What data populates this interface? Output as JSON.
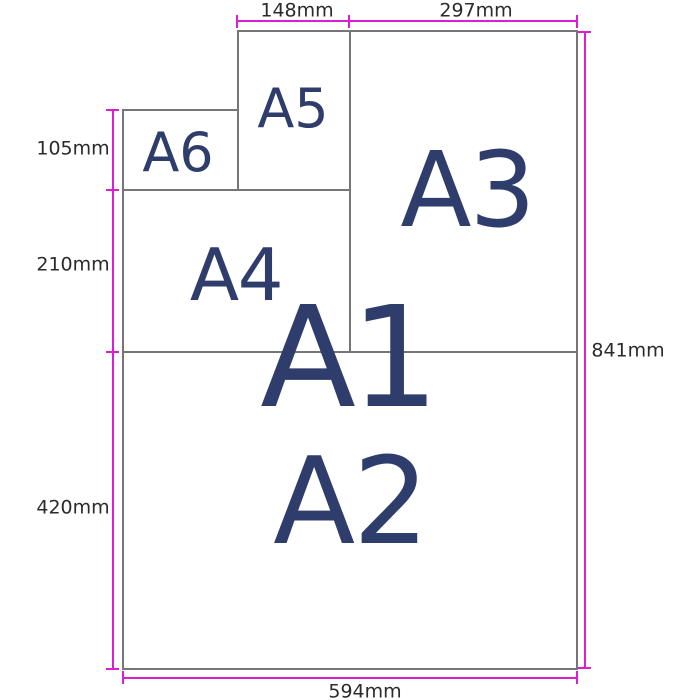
{
  "diagram": {
    "description": "A-series paper size comparison diagram",
    "papers": {
      "a1": "A1",
      "a2": "A2",
      "a3": "A3",
      "a4": "A4",
      "a5": "A5",
      "a6": "A6"
    },
    "measurements": {
      "a5_width": "148mm",
      "a3_width": "297mm",
      "a6_height": "105mm",
      "a4_height": "210mm",
      "a2_height": "420mm",
      "a1_height": "841mm",
      "a1_width": "594mm"
    },
    "colors": {
      "dimension_line": "#dc1ed2",
      "paper_border": "#767676",
      "paper_label": "#2e3d6b",
      "measurement_text": "#2b2b2b",
      "background": "#ffffff"
    }
  }
}
